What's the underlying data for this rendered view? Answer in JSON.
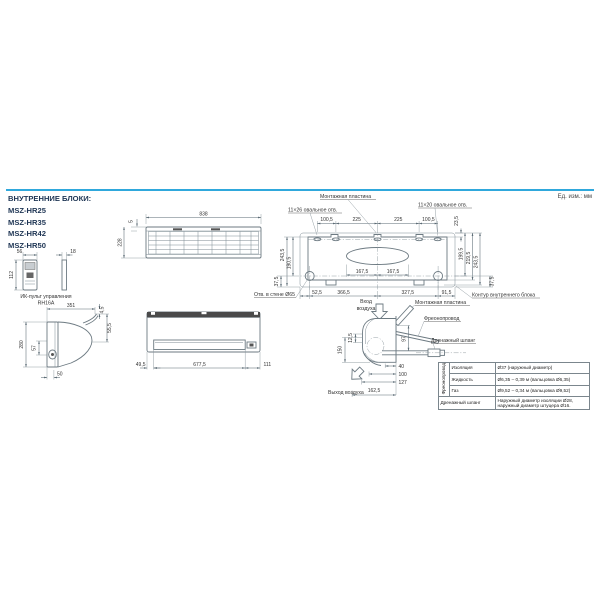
{
  "page": {
    "units_note": "Ед. изм.: мм"
  },
  "header": {
    "title": "ВНУТРЕННИЕ БЛОКИ:",
    "models": [
      "MSZ-HR25",
      "MSZ-HR35",
      "MSZ-HR42",
      "MSZ-HR50"
    ]
  },
  "remote": {
    "caption_line1": "ИК-пульт управления",
    "caption_line2": "RH16A",
    "dim_width": "56",
    "dim_depth": "18",
    "dim_height": "112"
  },
  "top_view": {
    "dim_width": "838",
    "dim_lip": "5",
    "dim_depth": "228"
  },
  "mounting_plate": {
    "label": "Монтажная пластина",
    "oval_hole_left": "11×26 овальное отв.",
    "oval_hole_right": "11×20 овальное отв.",
    "top_dims": [
      "100,5",
      "225",
      "225",
      "100,5"
    ],
    "dim_top_edge": "23,5",
    "left_dims": [
      "243,5",
      "190,5"
    ],
    "right_dims": [
      "199,5",
      "219,5",
      "243,5"
    ],
    "center_dims": [
      "167,5",
      "167,5"
    ],
    "bottom_dims": [
      "52,5",
      "366,5",
      "327,5",
      "91,5"
    ],
    "dim_hole_left": "37,5",
    "dim_hole_right": "37,5",
    "wall_hole_label": "Отв. в стене Ø65",
    "contour_label": "Контур внутреннего блока"
  },
  "side_view": {
    "dim_depth_total": "351",
    "dim_flap_top": "4,5",
    "dim_flap": "55,5",
    "dim_height": "280",
    "dim_pipe": "57",
    "dim_bottom": "50"
  },
  "front_view": {
    "bottom_dims": [
      "49,5",
      "677,5",
      "111"
    ]
  },
  "piping_view": {
    "air_inlet_line1": "Вход",
    "air_inlet_line2": "воздуха",
    "air_outlet": "Выход воздуха",
    "plate_label": "Монтажная пластина",
    "freon_label": "Фреонопровод",
    "drain_label": "Дренажный шланг",
    "dim_v1": "150",
    "dim_v2": "12,5",
    "dim_pipe": "97",
    "dim_h1": "40",
    "dim_h2": "100",
    "dim_h3": "127",
    "dim_h4": "162,5"
  },
  "spec_table": {
    "group_label": "Фреоно­провод",
    "rows": [
      {
        "name": "Изоляция",
        "value": "Ø37 (наружный диаметр)"
      },
      {
        "name": "Жидкость",
        "value": "Ø6,35 – 0,39 м (вальцовка Ø6,35)"
      },
      {
        "name": "Газ",
        "value": "Ø9,52 – 0,34 м (вальцовка Ø9,52)"
      },
      {
        "name": "Дренажный шланг",
        "value": "Наружный диаметр изоляции Ø28, наружный диаметр штуцера Ø16."
      }
    ]
  }
}
